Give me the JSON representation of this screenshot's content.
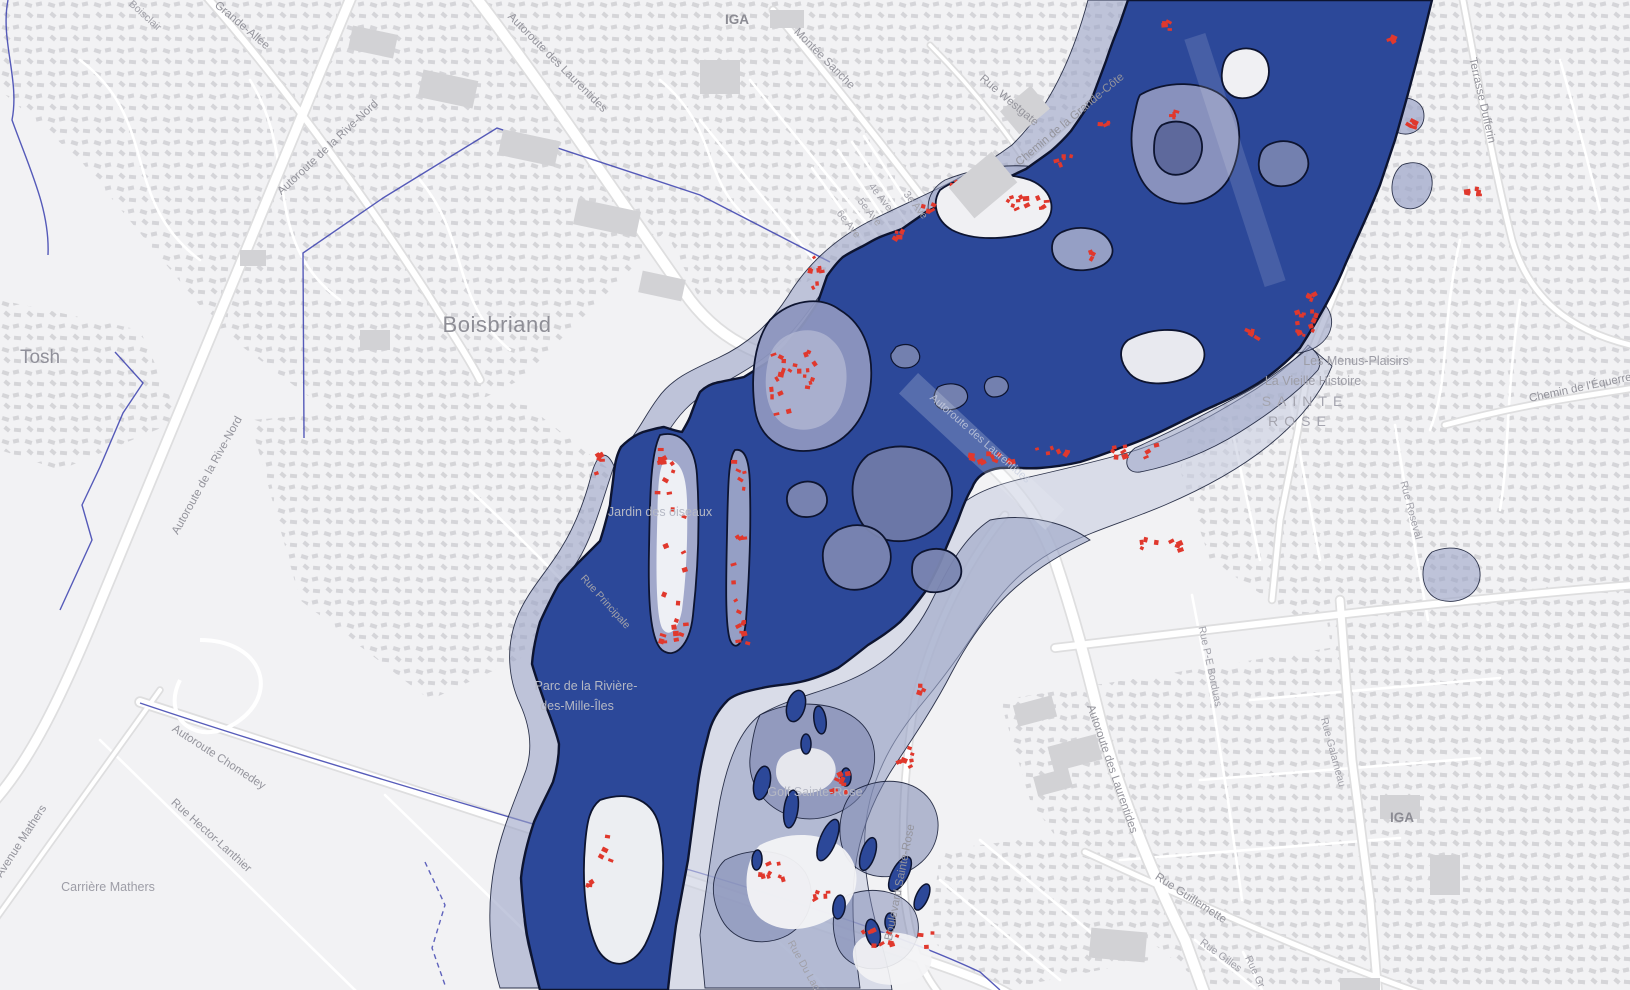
{
  "map": {
    "colors": {
      "land": "#f2f2f4",
      "water": "#2c4899",
      "water_outline": "#0d1430",
      "flood_zone_light": "#c8cde0",
      "flood_zone_mid": "#9ba4c7",
      "flood_zone_dark": "#7b86b1",
      "flooded_island": "#8d96bf",
      "building_generic": "#d0d0d4",
      "building_at_risk": "#e0382d",
      "road_fill": "#ffffff",
      "road_casing": "#dededf",
      "boundary_line": "#3a3fae",
      "label_gray": "#94949c"
    },
    "labels": [
      {
        "text": "Grande-Allée",
        "x": 240,
        "y": 28,
        "r": 40,
        "cls": "road"
      },
      {
        "text": "Boisclair",
        "x": 143,
        "y": 18,
        "r": 42,
        "cls": "road-sm"
      },
      {
        "text": "Autoroute de la Rive-Nord",
        "x": 330,
        "y": 150,
        "r": -43,
        "cls": "road"
      },
      {
        "text": "Autoroute des Laurentides",
        "x": 555,
        "y": 65,
        "r": 45,
        "cls": "road"
      },
      {
        "text": "IGA",
        "x": 737,
        "y": 24,
        "r": 0,
        "cls": "poi-dark"
      },
      {
        "text": "Montée Sanche",
        "x": 822,
        "y": 61,
        "r": 45,
        "cls": "road"
      },
      {
        "text": "Rue Westgate",
        "x": 1007,
        "y": 103,
        "r": 40,
        "cls": "road"
      },
      {
        "text": "Chemin de la Grande-Côte",
        "x": 1072,
        "y": 122,
        "r": -40,
        "cls": "road"
      },
      {
        "text": "4e Ave",
        "x": 878,
        "y": 199,
        "r": 52,
        "cls": "road-sm"
      },
      {
        "text": "3e Ave",
        "x": 913,
        "y": 207,
        "r": 52,
        "cls": "road-sm"
      },
      {
        "text": "5e Ave",
        "x": 867,
        "y": 214,
        "r": 52,
        "cls": "road-sm"
      },
      {
        "text": "6e Ave",
        "x": 846,
        "y": 226,
        "r": 52,
        "cls": "road-sm"
      },
      {
        "text": "Terrasse Dufferin",
        "x": 1479,
        "y": 101,
        "r": 77,
        "cls": "road"
      },
      {
        "text": "Tosh",
        "x": 40,
        "y": 363,
        "r": 0,
        "cls": "city-sm"
      },
      {
        "text": "Boisbriand",
        "x": 497,
        "y": 332,
        "r": 0,
        "cls": "city"
      },
      {
        "text": "Autoroute de la Rive-Nord",
        "x": 210,
        "y": 477,
        "r": -61,
        "cls": "road"
      },
      {
        "text": "Les Menus-Plaisirs",
        "x": 1356,
        "y": 365,
        "r": 0,
        "cls": "poi"
      },
      {
        "text": "La Vieille Histoire",
        "x": 1313,
        "y": 385,
        "r": 0,
        "cls": "poi"
      },
      {
        "text": "SAINTE",
        "x": 1305,
        "y": 406,
        "r": 0,
        "cls": "district"
      },
      {
        "text": "ROSE",
        "x": 1300,
        "y": 426,
        "r": 0,
        "cls": "district"
      },
      {
        "text": "Chemin de l'Équerre",
        "x": 1581,
        "y": 391,
        "r": -12,
        "cls": "road"
      },
      {
        "text": "Rue Roseval",
        "x": 1408,
        "y": 511,
        "r": 75,
        "cls": "road-sm"
      },
      {
        "text": "Rue P-E Borduas",
        "x": 1207,
        "y": 667,
        "r": 78,
        "cls": "road-sm"
      },
      {
        "text": "Jardin des oiseaux",
        "x": 660,
        "y": 516,
        "r": 0,
        "cls": "park"
      },
      {
        "text": "Rue Principale",
        "x": 603,
        "y": 604,
        "r": 48,
        "cls": "road-sm"
      },
      {
        "text": "Parc de la Rivière-",
        "x": 586,
        "y": 690,
        "r": 0,
        "cls": "park"
      },
      {
        "text": "des-Mille-Îles",
        "x": 577,
        "y": 710,
        "r": 0,
        "cls": "park"
      },
      {
        "text": "Autoroute Chomedey",
        "x": 217,
        "y": 760,
        "r": 33,
        "cls": "road"
      },
      {
        "text": "Rue Hector-Lanthier",
        "x": 209,
        "y": 838,
        "r": 42,
        "cls": "road"
      },
      {
        "text": "Avenue Mathers",
        "x": 24,
        "y": 843,
        "r": -57,
        "cls": "road"
      },
      {
        "text": "Carrière Mathers",
        "x": 108,
        "y": 891,
        "r": 0,
        "cls": "poi"
      },
      {
        "text": "Golf Sainte-Rose",
        "x": 815,
        "y": 796,
        "r": 0,
        "cls": "park"
      },
      {
        "text": "Boulevard Sainte-Rose",
        "x": 903,
        "y": 883,
        "r": -79,
        "cls": "road"
      },
      {
        "text": "Rue Du Lac",
        "x": 801,
        "y": 967,
        "r": 61,
        "cls": "road-sm"
      },
      {
        "text": "Rue Guillemette",
        "x": 1189,
        "y": 901,
        "r": 33,
        "cls": "road"
      },
      {
        "text": "Rue Gilles",
        "x": 1219,
        "y": 958,
        "r": 36,
        "cls": "road-sm"
      },
      {
        "text": "Rue Gr",
        "x": 1252,
        "y": 973,
        "r": 65,
        "cls": "road-sm"
      },
      {
        "text": "Autoroute des Laurentides",
        "x": 1109,
        "y": 770,
        "r": 71,
        "cls": "road"
      },
      {
        "text": "IGA",
        "x": 1402,
        "y": 822,
        "r": 0,
        "cls": "poi-dark"
      },
      {
        "text": "Rue Galarneau",
        "x": 1330,
        "y": 753,
        "r": 75,
        "cls": "road-sm"
      },
      {
        "text": "Autoroute des Laurentides",
        "x": 978,
        "y": 441,
        "r": 41,
        "cls": "water-road"
      }
    ],
    "red_building_clusters": [
      [
        816,
        278,
        14,
        48,
        8
      ],
      [
        900,
        235,
        16,
        10,
        5
      ],
      [
        928,
        207,
        14,
        10,
        4
      ],
      [
        1026,
        203,
        44,
        20,
        12
      ],
      [
        1064,
        160,
        16,
        12,
        5
      ],
      [
        1106,
        122,
        12,
        10,
        4
      ],
      [
        1168,
        28,
        10,
        14,
        4
      ],
      [
        1174,
        118,
        10,
        16,
        4
      ],
      [
        1305,
        315,
        26,
        48,
        16
      ],
      [
        1252,
        334,
        12,
        8,
        4
      ],
      [
        1410,
        125,
        14,
        10,
        4
      ],
      [
        1474,
        194,
        14,
        12,
        5
      ],
      [
        1392,
        40,
        8,
        10,
        3
      ],
      [
        793,
        390,
        44,
        90,
        22
      ],
      [
        672,
        545,
        30,
        195,
        26
      ],
      [
        739,
        548,
        12,
        180,
        14
      ],
      [
        596,
        464,
        14,
        20,
        5
      ],
      [
        1000,
        458,
        90,
        10,
        10
      ],
      [
        1122,
        452,
        70,
        14,
        9
      ],
      [
        1160,
        550,
        50,
        22,
        8
      ],
      [
        842,
        788,
        20,
        44,
        9
      ],
      [
        908,
        757,
        22,
        20,
        7
      ],
      [
        775,
        872,
        36,
        20,
        8
      ],
      [
        826,
        898,
        26,
        12,
        5
      ],
      [
        898,
        938,
        72,
        18,
        12
      ],
      [
        605,
        849,
        14,
        26,
        5
      ],
      [
        588,
        886,
        10,
        8,
        3
      ],
      [
        742,
        632,
        12,
        38,
        6
      ],
      [
        960,
        185,
        18,
        10,
        4
      ],
      [
        1090,
        255,
        12,
        10,
        3
      ],
      [
        920,
        690,
        12,
        10,
        3
      ],
      [
        1048,
        452,
        40,
        10,
        6
      ]
    ]
  }
}
